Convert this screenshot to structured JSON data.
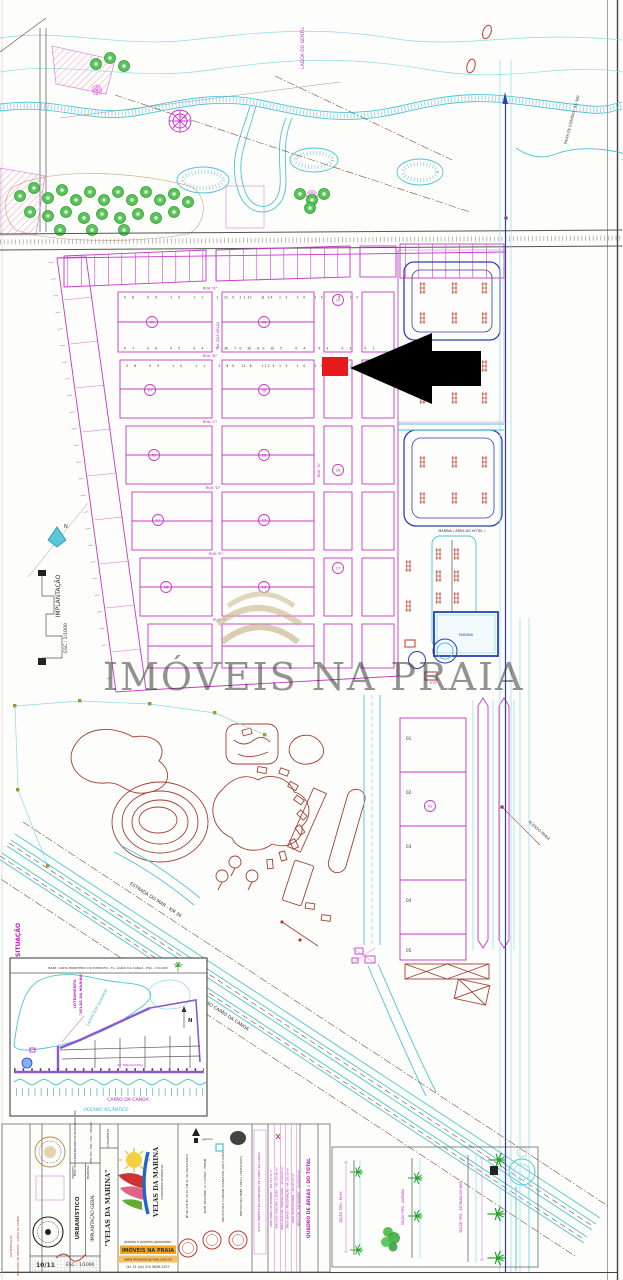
{
  "watermark": {
    "brand": "IMÓVEIS NA PRAIA"
  },
  "plan": {
    "north": "N",
    "implantacao_label": "IMPLANTAÇÃO",
    "implantacao_scale": "ESC.: 1/1000",
    "creek_label": "LAGOA DO GENTIL",
    "road_estrada": "ESTRADA DO MAR - KM 36",
    "road_acesso": "ACESSO CAPÃO DA CANOA",
    "road_acesso_praia": "ACESSO PRAIA",
    "faixa_dominio": "FAIXA DE DOMÍNIO - RS 389",
    "marina_area": "MARINA ( ÁREA DO HOTEL )",
    "ete_label": "ETE",
    "basin_label": "MARINA",
    "streets_h": [
      "RUA \"A\"",
      "RUA \"B\"",
      "RUA \"C\"",
      "RUA \"D\"",
      "RUA \"E\"",
      "RUA \"F\""
    ],
    "street_v1": "AV. DAS VELAS",
    "street_v2": "RUA \"G\"",
    "lots_row_a": "08 09 10 11 12 13 14",
    "lots_row_b": "07 06 05 04 03 02 01",
    "lots_row_c": "10 11 12 13 14 15 16 17",
    "big_lots": [
      "01",
      "02",
      "03",
      "04",
      "05"
    ],
    "block_ids": [
      "05",
      "06",
      "15",
      "07",
      "08",
      "16",
      "09",
      "10",
      "17",
      "11",
      "12",
      "18",
      "13",
      "02"
    ]
  },
  "inset": {
    "title": "SITUAÇÃO",
    "source": "BASE: CARTA MINISTÉRIO DO EXÉRCITO - FL. CAPÃO DA CANOA - ESC. 1:50.000",
    "lagoon": "LAGOA DOS QUADROS",
    "ocean": "OCEANO ATLÂNTICO",
    "city": "CAPÃO DA CANOA",
    "avenue": "AV. PARAGUASSU",
    "site_line1": "LOTEAMENTO",
    "site_line2": "\"VELAS DA MARINA\"",
    "north": "N"
  },
  "titleblock": {
    "loteamento_label": "LOTEAMENTO:",
    "loteamento_value": "\"VELAS DA MARINA\"",
    "projeto_label": "PROJETO:",
    "projeto_value": "URBANÍSTICO",
    "prancha_label": "PRANCHA:",
    "prancha_value": "IMPLANTAÇÃO GERAL",
    "owner_text": "PROP.: VDM EMPREENDIMENTOS IMOBILIÁRIOS LTDA.",
    "resp_text": "RESP. TÉC.: ENG. CIVIL - CREA/RS",
    "sheet": "10/11",
    "escala": "ESC.: 1/1000",
    "auth1": "AUTENTICAÇÃO",
    "auth2": "REGISTRO DE IMÓVEIS - CAPÃO DA CANOA",
    "agraria": "agraria",
    "logo_name": "VELAS DA MARINA",
    "logo_sub": "CONDOMÍNIO RESIDENCIAL",
    "contact_line0": "plantas e projetos aprovados:",
    "contact_line1": "IMÓVEIS NA PRAIA",
    "contact_line2": "www.imoveisnapraia.com.br",
    "contact_line3": "tel. 51 (xx) 510 9636-2207",
    "stamp1": "Nº 60.436 FL 36 LV 3-B CL 36 (06/10/2007)",
    "stamp2": "RI Nº 384/3888 - LI 17/2007 - FEPAM",
    "stamp3": "PROTOCOLO CORSAN 544683568 (28/11/2007)",
    "stamp4": "PROTOCOLO PREF. 190/11 (29/06/2007)",
    "approval": "VISTO: PREFEITURA MUNICIPAL DE CAPÃO DA CANOA",
    "quadro_header": "QUADRO DE ÁREAS : DO TOTAL",
    "quadro_rows": [
      "ÁREA TOTAL DO TERRENO - 483.057,42 m²",
      "ÁREA DAS QUADRAS / LOTES - 245.310,80 m²",
      "ÁREA VIAS LOT. \"MARINA PARK\" - 96.210,45 m²",
      "ÁREA VERDE / PRESERVAÇÃO - 84.120,10 m²",
      "ÁREA INSTITUCIONAL - 28.415,07 m²",
      "ÁREA COM. \"DO MIRANTE\" - 29.000,00 m²"
    ],
    "section1": "SEÇÃO TIPO - RUAS",
    "section2": "SEÇÃO TIPO - AVENIDA",
    "section3": "SEÇÃO TIPO - ESTRADA DO MAR"
  }
}
